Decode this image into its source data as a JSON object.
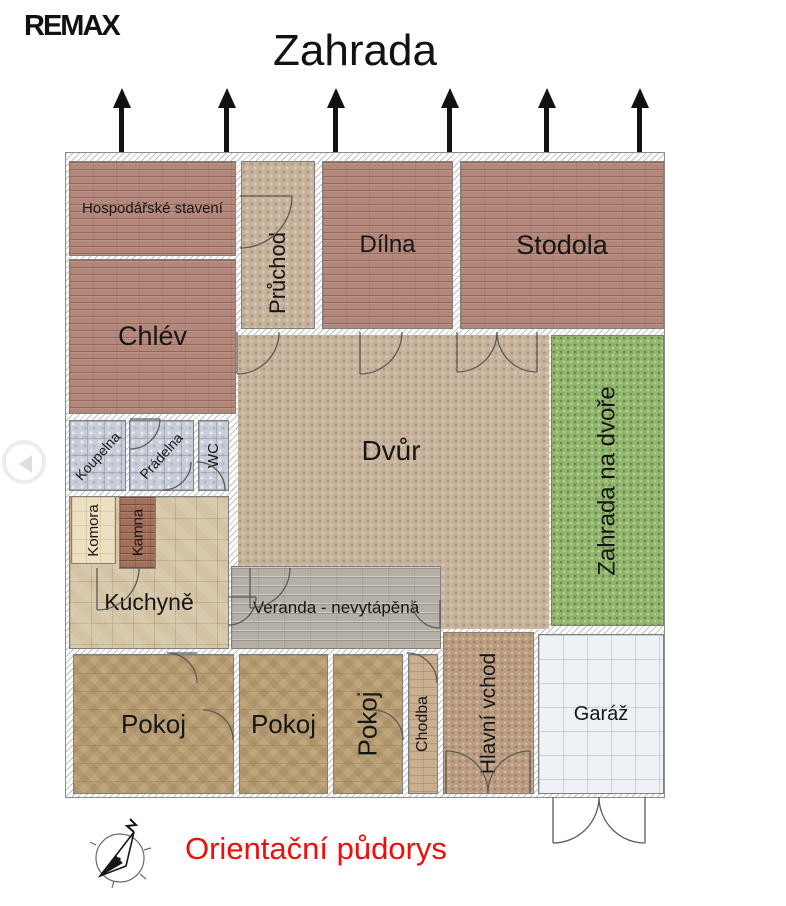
{
  "header": {
    "logo_text": "REMAX",
    "garden_label": "Zahrada",
    "garden_arrow_count": 6
  },
  "rooms": {
    "hospodarske_staveni": "Hospodářské stavení",
    "chlev": "Chlév",
    "pruchod": "Průchod",
    "dilna": "Dílna",
    "stodola": "Stodola",
    "dvur": "Dvůr",
    "zahrada_na_dvore": "Zahrada na dvoře",
    "koupelna": "Koupelna",
    "pradelna": "Prádelna",
    "wc": "WC",
    "komora": "Komora",
    "kamna": "Kamna",
    "kuchyne": "Kuchyně",
    "veranda": "Veranda - nevytápěná",
    "pokoj1": "Pokoj",
    "pokoj2": "Pokoj",
    "pokoj3": "Pokoj",
    "chodba": "Chodba",
    "hlavni_vchod": "Hlavní vchod",
    "garaz": "Garáž"
  },
  "footer": {
    "caption": "Orientační půdorys"
  },
  "palette": {
    "brick_red": "#b3887b",
    "courtyard_tan": "#c7b29b",
    "grass_green": "#92b56e",
    "bath_tile_grey": "#c9cdd8",
    "pantry_cream": "#ecdfc2",
    "stove_brown": "#a3705b",
    "kitchen_tile": "#d4c4a5",
    "veranda_grey": "#b6afa7",
    "room_wood": "#c0a67c",
    "hall_brick": "#c9ae90",
    "entry_brown": "#bb9e82",
    "garage_white": "#eef1f5",
    "caption_red": "#f20d0a",
    "ink": "#121212"
  }
}
